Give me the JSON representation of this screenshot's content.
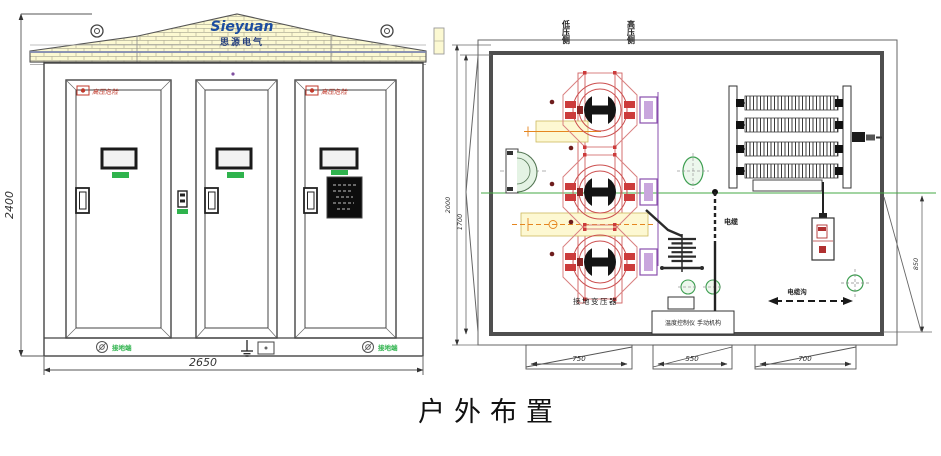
{
  "page": {
    "caption": "户外布置"
  },
  "colors": {
    "line": "#444444",
    "wall": "#4f4f4f",
    "brick_fill": "#fcf9d2",
    "roof_stripe": "#7f88b0",
    "logo_blue": "#1c4da0",
    "warning_red": "#c0392b",
    "detail_red": "#cc3b3b",
    "detail_purple": "#8a4fae",
    "safety_green": "#2fb34d",
    "centerline_green": "#44aa44",
    "band_yellow": "#fdf8d2",
    "orange": "#e5861f"
  },
  "elevation": {
    "dim_height": "2400",
    "dim_width": "2650",
    "logo": {
      "brand": "Sieyuan",
      "subtext": "思源电气"
    },
    "door_warning": "高压危险",
    "ground_label_left": "接地端",
    "ground_label_right": "接地端"
  },
  "plan": {
    "side_label_left": "低压侧",
    "side_label_right": "高压侧",
    "transformer_label": "接地变压器",
    "controller_label": "温度控制仪 手动机构",
    "cable_label": "电缆",
    "trench_label": "电缆沟",
    "dim_depth_outer": "2000",
    "dim_depth_inner": "1700",
    "dim_right": "850",
    "dim_bottom": [
      "750",
      "550",
      "700"
    ]
  }
}
